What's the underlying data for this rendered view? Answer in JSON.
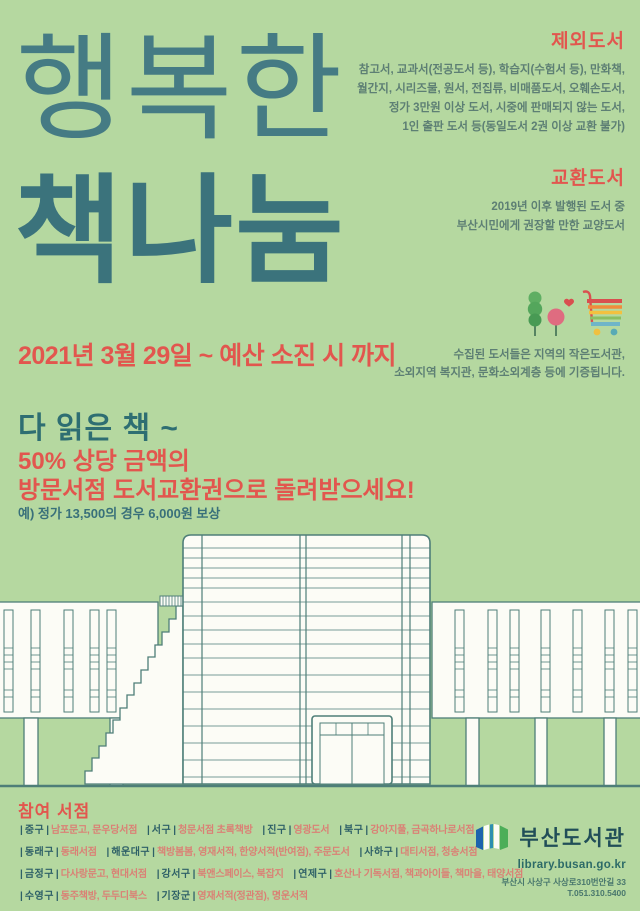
{
  "poster": {
    "title_line1": "행복한",
    "title_line2": "책나눔",
    "date": "2021년 3월 29일 ~ 예산 소진 시 까지",
    "excluded": {
      "heading": "제외도서",
      "lines": [
        "참고서, 교과서(전공도서 등), 학습지(수험서 등), 만화책,",
        "월간지, 시리즈물, 원서, 전집류, 비매품도서, 오훼손도서,",
        "정가 3만원 이상 도서, 시중에 판매되지 않는 도서,",
        "1인 출판 도서 등(동일도서 2권 이상 교환 불가)"
      ]
    },
    "exchange": {
      "heading": "교환도서",
      "lines": [
        "2019년 이후 발행된 도서 중",
        "부산시민에게 권장할 만한 교양도서"
      ]
    },
    "donation_lines": [
      "수집된 도서들은 지역의 작은도서관,",
      "소외지역 복지관, 문화소외계층 등에 기증됩니다."
    ],
    "promo": {
      "line1": "다 읽은 책 ~",
      "line2": "50% 상당 금액의",
      "line3": "방문서점 도서교환권으로 돌려받으세요!",
      "example": "예) 정가 13,500의 경우 6,000원 보상"
    },
    "bookstores": {
      "heading": "참여 서점",
      "sep": "|",
      "rows": [
        [
          {
            "district": "중구",
            "stores": "남포문고, 문우당서점"
          },
          {
            "district": "서구",
            "stores": "청문서점 초록책방"
          },
          {
            "district": "진구",
            "stores": "영광도서"
          },
          {
            "district": "북구",
            "stores": "강아지풀, 금곡하나로서점"
          }
        ],
        [
          {
            "district": "동래구",
            "stores": "동래서점"
          },
          {
            "district": "해운대구",
            "stores": "책방봄봄, 영재서적, 한양서적(반여점), 주문도서"
          },
          {
            "district": "사하구",
            "stores": "대티서점, 청송서점"
          }
        ],
        [
          {
            "district": "금정구",
            "stores": "다사랑문고, 현대서점"
          },
          {
            "district": "강서구",
            "stores": "북앤스페이스, 북잡지"
          },
          {
            "district": "연제구",
            "stores": "호산나 기독서점, 책과아이들, 책마을, 태양서점"
          }
        ],
        [
          {
            "district": "수영구",
            "stores": "동주책방, 두두디북스"
          },
          {
            "district": "기장군",
            "stores": "영재서적(정관점), 명운서적"
          }
        ]
      ]
    },
    "footer": {
      "library_name": "부산도서관",
      "website": "library.busan.go.kr",
      "address": "부산시 사상구 사상로310번안길 33",
      "phone": "T.051.310.5400"
    },
    "icons": {
      "green_tree": "green-tree-icon",
      "pink_tree": "pink-tree-heart-icon",
      "cart": "shopping-cart-icon",
      "logo": "open-book-logo-icon"
    },
    "colors": {
      "background": "#b5d8a0",
      "teal_title": "#3b737c",
      "accent_red": "#e2564e",
      "text_teal": "#5d7f74",
      "store_coral": "#da8175",
      "building_stroke": "#4e7e78"
    }
  }
}
